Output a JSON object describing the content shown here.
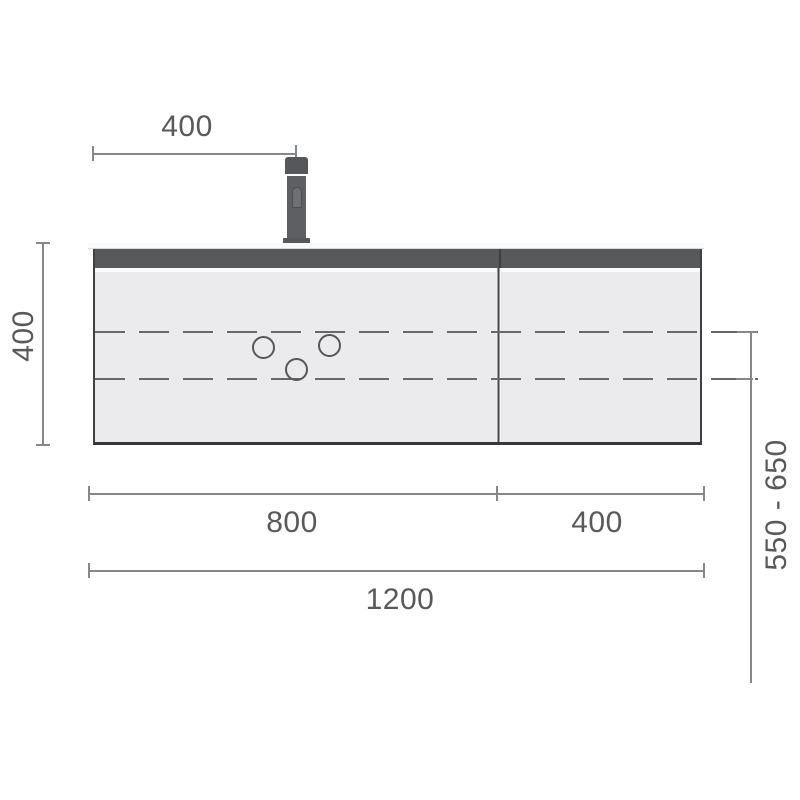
{
  "drawing": {
    "subject": "vanity-unit-front-elevation",
    "dimensions": {
      "tap_offset": "400",
      "cabinet_height": "400",
      "left_door_width": "800",
      "right_door_width": "400",
      "total_width": "1200",
      "drain_height_range": "550 - 650"
    },
    "colors": {
      "accent_band": "#58595b",
      "outline": "#3f4042",
      "dimension_line": "#85878a",
      "label_text": "#58595b",
      "cabinet_fill": "#ebebed",
      "dash_color": "#66686b"
    }
  }
}
